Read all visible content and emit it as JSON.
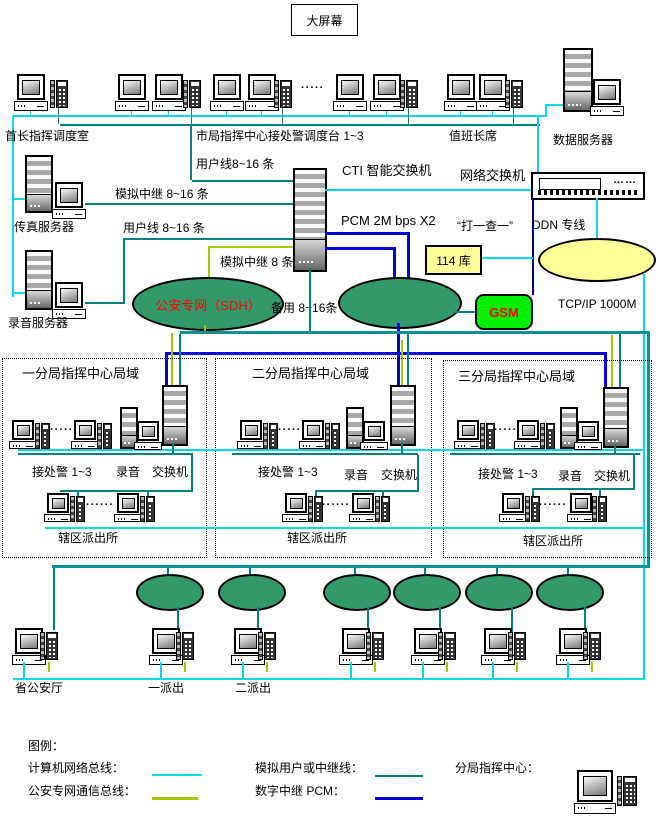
{
  "bigscreen": "大屏幕",
  "dots5": "·····",
  "dots6": "······",
  "top_labels": {
    "chief": "首长指挥调度室",
    "city": "市局指挥中心接处警调度台 1~3",
    "duty": "值班长席",
    "dataserver": "数据服务器"
  },
  "servers": {
    "fax": "传真服务器",
    "record": "录音服务器"
  },
  "center": {
    "cti": "CTI 智能交换机",
    "pcm": "PCM 2M bps X2",
    "netswitch": "网络交换机",
    "switch_dots": "……",
    "ddn": "DDN 专线",
    "dialquery": "“打一查一”",
    "db114": "114 库",
    "gsm": "GSM",
    "tcpip": "TCP/IP  1000M",
    "sdh": "公安专网（SDH）",
    "userline1": "用户线8~16 条",
    "analog_trunk": "模拟中继 8~16 条",
    "userline2": "用户线 8~16 条",
    "analog8": "模拟中继 8 条",
    "backup": "备用 8~16条"
  },
  "branches": [
    {
      "title": "一分局指挥中心局域",
      "police": "接处警 1~3",
      "record": "录音",
      "switch": "交换机",
      "station": "辖区派出所"
    },
    {
      "title": "二分局指挥中心局域",
      "police": "接处警 1~3",
      "record": "录音",
      "switch": "交换机",
      "station": "辖区派出所"
    },
    {
      "title": "三分局指挥中心局域",
      "police": "接处警 1~3",
      "record": "录音",
      "switch": "交换机",
      "station": "辖区派出所"
    }
  ],
  "bottom": {
    "provincial": "省公安厅",
    "dispatch1": "一派出",
    "dispatch2": "二派出"
  },
  "legend": {
    "title": "图例：",
    "computer_bus": "计算机网络总线：",
    "sdh_bus": "公安专网通信总线：",
    "analog_line": "模拟用户或中继线：",
    "digital_pcm": "数字中继 PCM：",
    "branch_center": "分局指挥中心："
  },
  "colors": {
    "computer_bus": "#00d8ee",
    "sdh_bus": "#a6c800",
    "analog_line": "#008080",
    "digital_pcm": "#0000dd",
    "green_ellipse": "#33996b",
    "yellow_ellipse": "#ffff99",
    "gsm_green": "#00ee00",
    "warning_red": "#ff0000"
  }
}
